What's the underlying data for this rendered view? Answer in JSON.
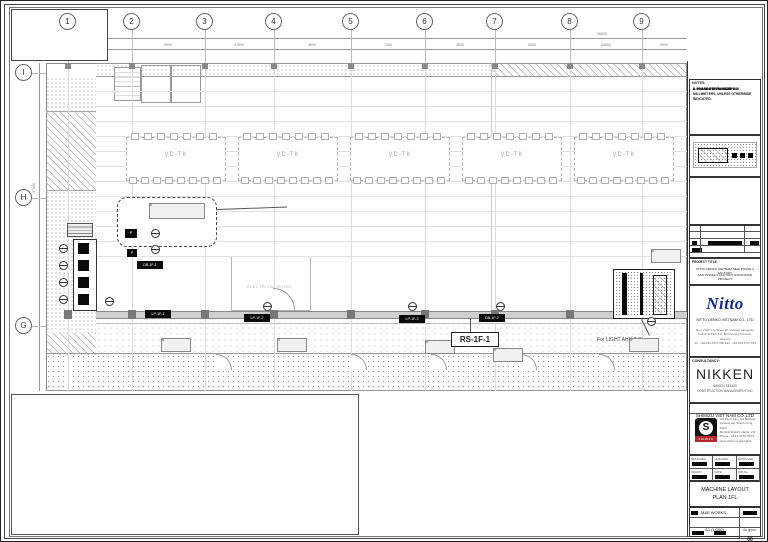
{
  "titleblock": {
    "notes": {
      "title": "NOTES:",
      "lines": [
        "1. ALL DIMENSIONS ARE IN MILLIMETERS, UNLESS OTHERWISE INDICATED.",
        "2. PHASE 4 1F  FL=+4.50",
        "3. PHASE 4 1F  FL=+4.50+0.10",
        "4. PHASE 3  FL=+4.50",
        "5. PHASE 3 1F  FL=+4.50+0.10"
      ]
    },
    "revision": {
      "approval": "THE APPROVAL",
      "description": "DESCRIPTION",
      "date": "DATE"
    },
    "project": {
      "label": "PROJECT TITLE:",
      "name_line1": "NITTO DENKO VIETNAM NEW PHASE 4 FACTORY",
      "name_line2": "AND PHASE 3 FACTORY EXPANSION PROJECT"
    },
    "owner": {
      "logo": "Nitto",
      "logo_color": "#16288e",
      "company": "NITTO DENKO VIETNAM CO., LTD",
      "addr_lines": [
        "No.2 VSIP II-A, Street 30, Vietnam Singapore",
        "Industrial Park II-A, Binh Duong Province, Vietnam",
        "Tel : +84-650-3757-650   Fax : +84-650-3757-651"
      ]
    },
    "consultancy": {
      "label": "CONSULTANCY:",
      "name": "NIKKEN",
      "sub1": "NIKKEN SEKKEI",
      "sub2": "CONSTRUCTION MANAGEMENT INC"
    },
    "contractor": {
      "name": "SHIMIZU VIET NAM CO.,LTD",
      "logo_text": "SHIMIZU",
      "addr_lines": [
        "3rd Floor, Lang Ha Building",
        "11/Lang Ha, Thanh Cong Ward",
        "Ba Dinh District, Hanoi, V.N",
        "Phone : +84-4-3772-XXXX",
        "www.shimz.co.jp/english"
      ]
    },
    "info": {
      "row1": [
        "DESIGNED",
        "CHECKED",
        "APPROVED"
      ],
      "row2": [
        "DRAWN",
        "DATE",
        "JOB No."
      ]
    },
    "drawing": {
      "title_line1": "MACHINE LAYOUT",
      "title_line2": "PLAN 1FL",
      "work": "M&E WORKS",
      "scale": "A1 (1/100)",
      "approval": "As appro.",
      "number": "00"
    }
  },
  "grid": {
    "cols": [
      {
        "label": "1",
        "x": 67
      },
      {
        "label": "2",
        "x": 131
      },
      {
        "label": "3",
        "x": 204
      },
      {
        "label": "4",
        "x": 273
      },
      {
        "label": "5",
        "x": 350
      },
      {
        "label": "6",
        "x": 424
      },
      {
        "label": "7",
        "x": 494
      },
      {
        "label": "8",
        "x": 569
      },
      {
        "label": "9",
        "x": 641
      }
    ],
    "rows": [
      {
        "label": "I",
        "y": 72
      },
      {
        "label": "H",
        "y": 197
      },
      {
        "label": "G",
        "y": 325
      }
    ]
  },
  "dims": {
    "overall": "96000",
    "left_vertical": "37000",
    "segments": [
      {
        "label": "(800)",
        "x": 62
      },
      {
        "label": "8700",
        "x": 99
      },
      {
        "label": "9000",
        "x": 167
      },
      {
        "label": "17000",
        "x": 238
      },
      {
        "label": "4500",
        "x": 311
      },
      {
        "label": "7400",
        "x": 387
      },
      {
        "label": "4500",
        "x": 459
      },
      {
        "label": "9000",
        "x": 531
      },
      {
        "label": "(4500)",
        "x": 605
      },
      {
        "label": "9000",
        "x": 663
      }
    ]
  },
  "plan": {
    "cluster_label": "VD-TK",
    "clusters": [
      {
        "x": 125
      },
      {
        "x": 237
      },
      {
        "x": 349
      },
      {
        "x": 461
      },
      {
        "x": 573
      }
    ],
    "room_label": "ELECTRICAL ROOM",
    "main_label": "RS-1F-1",
    "light_label": "For LIGHT AHU-2-3",
    "panels": [
      {
        "text": "DB-1F-1",
        "x": 136,
        "y": 260
      },
      {
        "text": "LP-1F-1",
        "x": 144,
        "y": 309
      },
      {
        "text": "LP-1F-2",
        "x": 243,
        "y": 313
      },
      {
        "text": "LP-1F-3",
        "x": 398,
        "y": 314
      },
      {
        "text": "DB-1F-2",
        "x": 478,
        "y": 313
      }
    ],
    "symbols": [
      {
        "x": 104,
        "y": 296
      },
      {
        "x": 150,
        "y": 228
      },
      {
        "x": 150,
        "y": 244
      },
      {
        "x": 262,
        "y": 301
      },
      {
        "x": 407,
        "y": 301
      },
      {
        "x": 495,
        "y": 301
      },
      {
        "x": 646,
        "y": 316
      }
    ],
    "gray_tables": [
      {
        "x": 160,
        "y": 337
      },
      {
        "x": 276,
        "y": 337
      },
      {
        "x": 424,
        "y": 339
      },
      {
        "x": 492,
        "y": 347
      },
      {
        "x": 628,
        "y": 337
      },
      {
        "x": 650,
        "y": 248
      }
    ]
  }
}
